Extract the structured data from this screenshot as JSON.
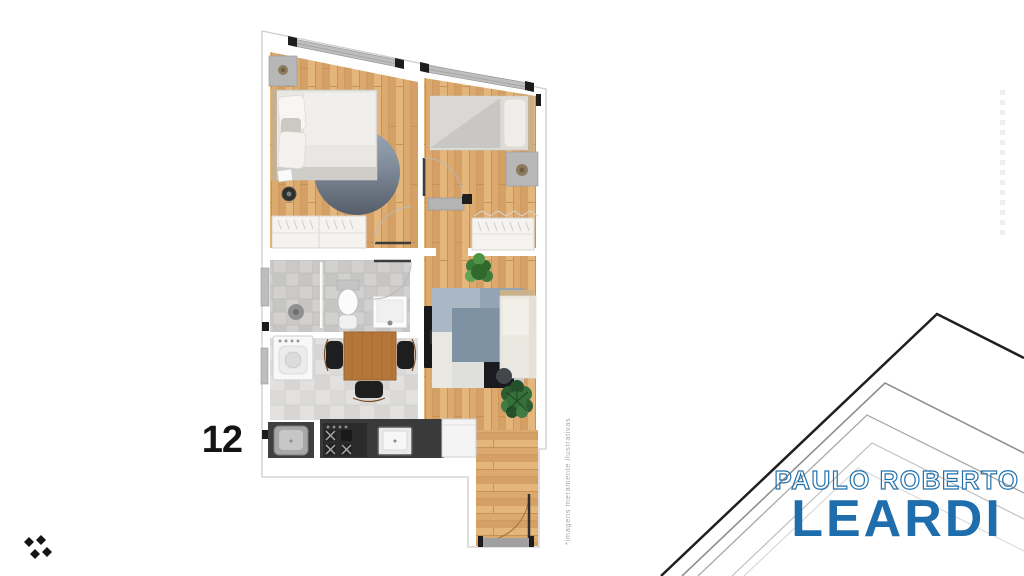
{
  "page": {
    "background_color": "#ffffff"
  },
  "plan": {
    "unit_number": "12",
    "disclaimer": "*imagens meramente ilustrativas",
    "materials": {
      "wood": "#dcaa6e",
      "bathroom_tile": "#d2d1cf",
      "dining_tile": "#e2e1df",
      "round_rug": "#59616d",
      "area_rug_blue": "#7e92a3",
      "area_rug_black": "#191b1f",
      "kitchen_counter": "#3a3a3a"
    }
  },
  "branding": {
    "line1": "PAULO ROBERTO",
    "line2": "LEARDI",
    "logo_color": "#1e6dad",
    "mark": "four-diamonds-icon"
  }
}
